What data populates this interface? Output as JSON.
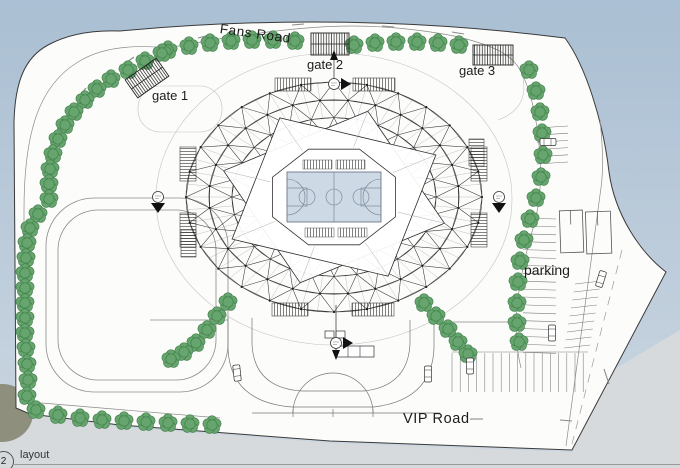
{
  "labels": {
    "fans_road": "Fans Road",
    "gate_1": "gate 1",
    "gate_2": "gate 2",
    "gate_3": "gate 3",
    "parking": "parking",
    "vip_road": "VIP Road"
  },
  "title_block": {
    "number": "2",
    "name": "layout"
  },
  "colors": {
    "sky_top": "#aabfd3",
    "sky_bottom": "#ccd7e1",
    "ground": "#d7dadd",
    "paper": "#fcfcfa",
    "tree_fill": "#67a56e",
    "tree_edge": "#43804d",
    "court_fill": "#cdd9e4",
    "court_line": "#6f8094",
    "star_fill": "#ffffff",
    "olive_sphere": "#8f8f7d"
  }
}
